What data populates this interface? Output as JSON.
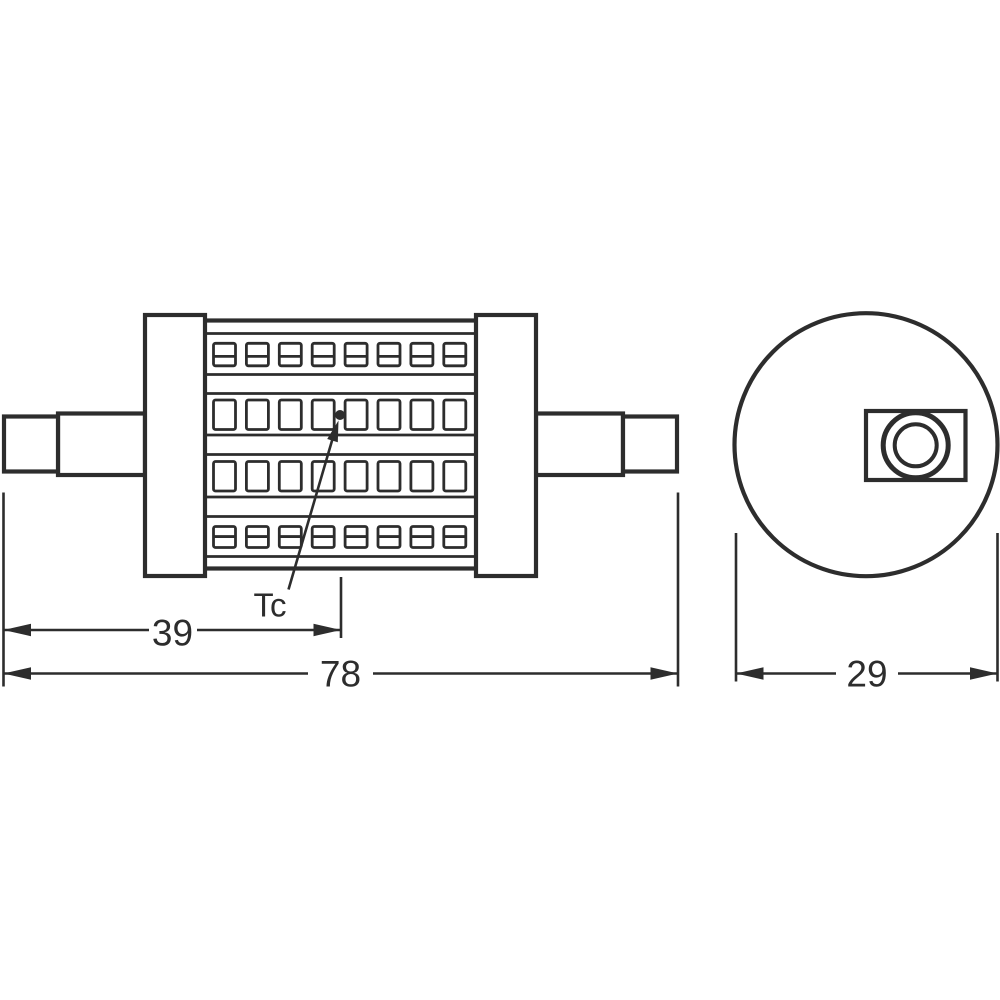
{
  "diagram": {
    "kind": "technical dimension drawing",
    "subject": "double-ended linear LED lamp, side view and end view",
    "labels": {
      "tc": "Tc"
    },
    "dimensions": {
      "tc_distance": "39",
      "overall_length": "78",
      "diameter": "29"
    },
    "colors": {
      "line": "#2d2d2d",
      "background": "#ffffff"
    },
    "side_view": {
      "led_rows": [
        {
          "style": "split",
          "count": 8
        },
        {
          "style": "solid",
          "count": 8
        },
        {
          "style": "solid",
          "count": 8
        },
        {
          "style": "split",
          "count": 8
        }
      ]
    }
  }
}
